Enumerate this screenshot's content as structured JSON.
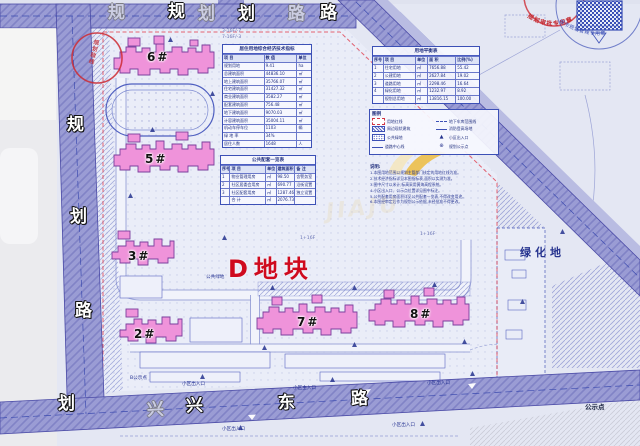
{
  "title": "居住小区修建性详细规划总平面图",
  "colors": {
    "road": "#8f91cf",
    "building_pink": "#ef93da",
    "accent_red": "#cf1126",
    "blueprint_blue": "#3c50b6",
    "leaf_gold": "#edbf4a"
  },
  "roads": {
    "top": {
      "name": "规划路",
      "chars": [
        "规",
        "划",
        "路"
      ],
      "ghost": [
        "规",
        "划",
        "路"
      ]
    },
    "left": {
      "name": "规划路",
      "chars": [
        "规",
        "划",
        "路"
      ],
      "extra": "划"
    },
    "bottom": {
      "name": "兴东路",
      "chars": [
        "兴",
        "东",
        "路"
      ],
      "ghost": "兴"
    }
  },
  "site": {
    "plot_label": "D地块",
    "green_area_label": "绿化地"
  },
  "buildings": [
    {
      "id": "6#"
    },
    {
      "id": "5#"
    },
    {
      "id": "3#"
    },
    {
      "id": "2#"
    },
    {
      "id": "7#"
    },
    {
      "id": "8#"
    }
  ],
  "tables": {
    "main": {
      "title": "居住用地综合经济技术指标",
      "header": [
        "项 目",
        "数 值",
        "单位"
      ],
      "rows": [
        [
          "规划用地",
          "9.41",
          "ha"
        ],
        [
          "总建筑面积",
          "44836.10",
          "㎡"
        ],
        [
          "地上建筑面积",
          "35766.07",
          "㎡"
        ],
        [
          "住宅建筑面积",
          "31427.32",
          "㎡"
        ],
        [
          "商业建筑面积",
          "3582.27",
          "㎡"
        ],
        [
          "配套建筑面积",
          "756.48",
          "㎡"
        ],
        [
          "地下建筑面积",
          "9070.03",
          "㎡"
        ],
        [
          "计容建筑面积",
          "35004.11",
          "㎡"
        ],
        [
          "机动车停车位",
          "1103",
          "辆"
        ],
        [
          "绿 地 率",
          "34%",
          ""
        ],
        [
          "居住人数",
          "1648",
          "人"
        ]
      ]
    },
    "public": {
      "title": "公共配套一览表",
      "header": [
        "序号",
        "项 目",
        "单位",
        "建筑面积",
        "备 注"
      ],
      "rows": [
        [
          "1",
          "物业管理用房",
          "㎡",
          "98.50",
          "含警务室"
        ],
        [
          "2",
          "社区居委会用房",
          "㎡",
          "690.77",
          "沿街设置"
        ],
        [
          "3",
          "社区配套用房",
          "㎡",
          "1287.46",
          "独立设置"
        ],
        [
          "",
          "合 计",
          "㎡",
          "2076.73",
          ""
        ]
      ]
    },
    "balance": {
      "title": "用地平衡表",
      "header": [
        "序号",
        "项 目",
        "单位",
        "面 积",
        "比例(%)"
      ],
      "rows": [
        [
          "1",
          "住宅用地",
          "㎡",
          "7656.88",
          "55.42"
        ],
        [
          "2",
          "公建用地",
          "㎡",
          "2627.84",
          "19.02"
        ],
        [
          "3",
          "道路用地",
          "㎡",
          "2298.46",
          "16.64"
        ],
        [
          "4",
          "绿化用地",
          "㎡",
          "1232.97",
          "8.92"
        ],
        [
          "",
          "规划总用地",
          "㎡",
          "13816.15",
          "100.00"
        ]
      ]
    }
  },
  "legend": {
    "title": "图例",
    "items": [
      {
        "label": "用地红线"
      },
      {
        "label": "地下车库范围线"
      },
      {
        "label": "周边现状建筑"
      },
      {
        "label": "消防登高场地"
      },
      {
        "label": "公共绿地"
      },
      {
        "label": "小区出入口"
      },
      {
        "label": "道路中心线"
      },
      {
        "label": "规划公示点"
      }
    ]
  },
  "notes": {
    "title": "说明:",
    "lines": [
      "1.本图用地范围以规划主管部门核定的用地红线为准。",
      "2.技术经济指标详见本图指标表,面积以实测为准。",
      "3.图中尺寸以米计,标高采用黄海高程系统。",
      "4.小区出入口、公示点位置详见图中标注。",
      "5.公共配套用房面积详见公共配套一览表,不得改变用途。",
      "6.本图经审定后作为规划公示依据,未经批准不得更改。"
    ]
  },
  "stamps": {
    "red_arc_text": "规划审批专用章",
    "blue_arc_text": "城市规划管理专用章",
    "boundary_seal_text": "规划验线"
  },
  "annotations": {
    "tiny": [
      {
        "t": "B公示点"
      },
      {
        "t": "小区出入口"
      },
      {
        "t": "小区主入口"
      },
      {
        "t": "小区出入口"
      },
      {
        "t": "公示点"
      },
      {
        "t": "公共绿地"
      },
      {
        "t": "1+16F"
      },
      {
        "t": "1+16F"
      },
      {
        "t": "3-16F/-7"
      },
      {
        "t": "7-16F/-3"
      },
      {
        "t": "小区出入口"
      },
      {
        "t": "小区出入口"
      }
    ]
  },
  "watermark": {
    "ghost_text": "JIAJU",
    "logo": "leaf-logo"
  }
}
